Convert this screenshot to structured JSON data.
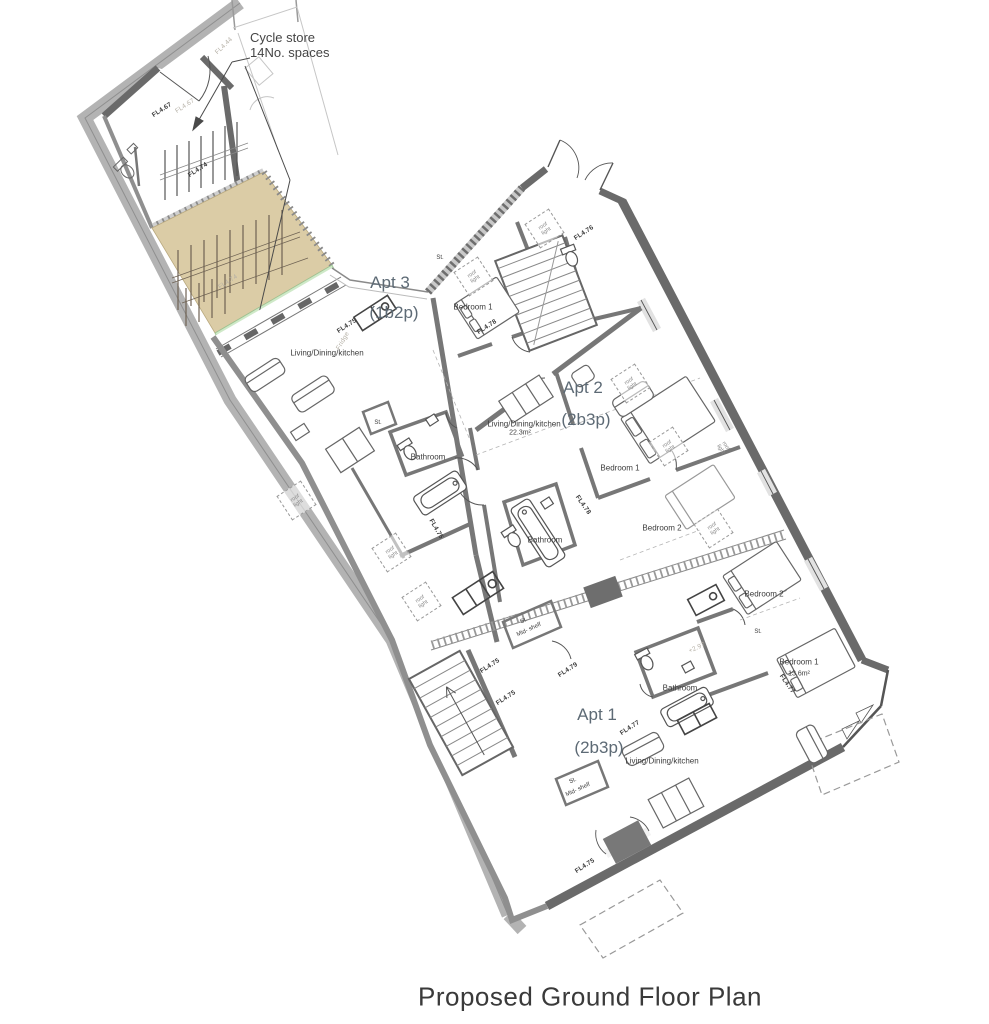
{
  "title": "Proposed Ground Floor Plan",
  "cycle_note": {
    "line1": "Cycle store",
    "line2": "14No. spaces"
  },
  "apartments": [
    {
      "name": "Apt 3",
      "occupancy": "(1b2p)",
      "nx": 390,
      "ny": 283,
      "ox": 394,
      "oy": 313
    },
    {
      "name": "Apt 2",
      "occupancy": "(2b3p)",
      "nx": 583,
      "ny": 388,
      "ox": 586,
      "oy": 420
    },
    {
      "name": "Apt 1",
      "occupancy": "(2b3p)",
      "nx": 597,
      "ny": 715,
      "ox": 599,
      "oy": 748
    }
  ],
  "room_labels": [
    {
      "t": "Living/Dining/kitchen",
      "x": 327,
      "y": 353
    },
    {
      "t": "Bedroom 1",
      "x": 473,
      "y": 307
    },
    {
      "t": "Bathroom",
      "x": 428,
      "y": 457
    },
    {
      "t": "Living/Dining/kitchen",
      "x": 524,
      "y": 424
    },
    {
      "t": "22.3m²",
      "x": 520,
      "y": 433,
      "s": 7
    },
    {
      "t": "Bedroom 1",
      "x": 620,
      "y": 468
    },
    {
      "t": "Bathroom",
      "x": 545,
      "y": 540
    },
    {
      "t": "Bedroom 2",
      "x": 662,
      "y": 528
    },
    {
      "t": "Bedroom 2",
      "x": 764,
      "y": 594
    },
    {
      "t": "Bedroom 1",
      "x": 799,
      "y": 662
    },
    {
      "t": "13.6m²",
      "x": 799,
      "y": 674,
      "s": 7
    },
    {
      "t": "Bathroom",
      "x": 680,
      "y": 688
    },
    {
      "t": "Living/Dining/kitchen",
      "x": 662,
      "y": 761
    }
  ],
  "small_labels": [
    {
      "t": "St.",
      "x": 378,
      "y": 423
    },
    {
      "t": "St.",
      "x": 440,
      "y": 258
    },
    {
      "t": "St.",
      "x": 758,
      "y": 632
    },
    {
      "t": "St.",
      "x": 524,
      "y": 621,
      "r": -25
    },
    {
      "t": "Mid- shelf",
      "x": 529,
      "y": 630,
      "r": -25
    },
    {
      "t": "St.",
      "x": 573,
      "y": 781,
      "r": -25
    },
    {
      "t": "Mid- shelf",
      "x": 578,
      "y": 790,
      "r": -25
    }
  ],
  "level_labels": [
    {
      "t": "FL4.67",
      "x": 162,
      "y": 110,
      "r": -33
    },
    {
      "t": "FL4.67",
      "x": 185,
      "y": 106,
      "r": -33,
      "light": 1
    },
    {
      "t": "FL4.74",
      "x": 198,
      "y": 170,
      "r": -33
    },
    {
      "t": "FL4.74",
      "x": 228,
      "y": 282,
      "r": -33,
      "light": 1
    },
    {
      "t": "FL4.44",
      "x": 224,
      "y": 46,
      "r": -44,
      "light": 1
    },
    {
      "t": "FL4.75",
      "x": 347,
      "y": 326,
      "r": -33
    },
    {
      "t": "Fridge",
      "x": 343,
      "y": 341,
      "r": -60,
      "light": 1
    },
    {
      "t": "FL4.75",
      "x": 436,
      "y": 529,
      "r": 60
    },
    {
      "t": "FL4.76",
      "x": 584,
      "y": 233,
      "r": -33
    },
    {
      "t": "FL4.78",
      "x": 487,
      "y": 327,
      "r": -33
    },
    {
      "t": "FL4.78",
      "x": 583,
      "y": 505,
      "r": 55
    },
    {
      "t": "FL4.75",
      "x": 490,
      "y": 666,
      "r": -33
    },
    {
      "t": "FL4.75",
      "x": 506,
      "y": 698,
      "r": -33
    },
    {
      "t": "FL4.79",
      "x": 568,
      "y": 670,
      "r": -33
    },
    {
      "t": "FL4.77",
      "x": 630,
      "y": 728,
      "r": -33
    },
    {
      "t": "FL4.77",
      "x": 787,
      "y": 684,
      "r": 55
    },
    {
      "t": "FL4.75",
      "x": 585,
      "y": 866,
      "r": -33
    },
    {
      "t": "+2.97",
      "x": 697,
      "y": 648,
      "r": -25,
      "light": 1
    }
  ],
  "roof_lights": {
    "label": "roof light",
    "boxes": [
      {
        "x": 472,
        "y": 275,
        "r": -33
      },
      {
        "x": 543,
        "y": 227,
        "r": -33
      },
      {
        "x": 629,
        "y": 382,
        "r": -33
      },
      {
        "x": 667,
        "y": 445,
        "r": -33
      },
      {
        "x": 712,
        "y": 527,
        "r": -33
      },
      {
        "x": 295,
        "y": 499,
        "r": -33
      },
      {
        "x": 390,
        "y": 551,
        "r": -33
      },
      {
        "x": 420,
        "y": 600,
        "r": -33
      },
      {
        "x": 723,
        "y": 447,
        "r": 57,
        "noborder": 1
      }
    ]
  },
  "colors": {
    "wall_dark": "#6a6a6a",
    "wall_mid": "#777777",
    "boundary_band": "#b3b3b3",
    "yard_beige": "#dbcca6",
    "planting_green_light": "#cfe9c8",
    "planting_green_dark": "#5f9e57",
    "window_slot": "#e2e2e2",
    "text": "#3b3b3b",
    "apt_text": "#5d6a75"
  }
}
